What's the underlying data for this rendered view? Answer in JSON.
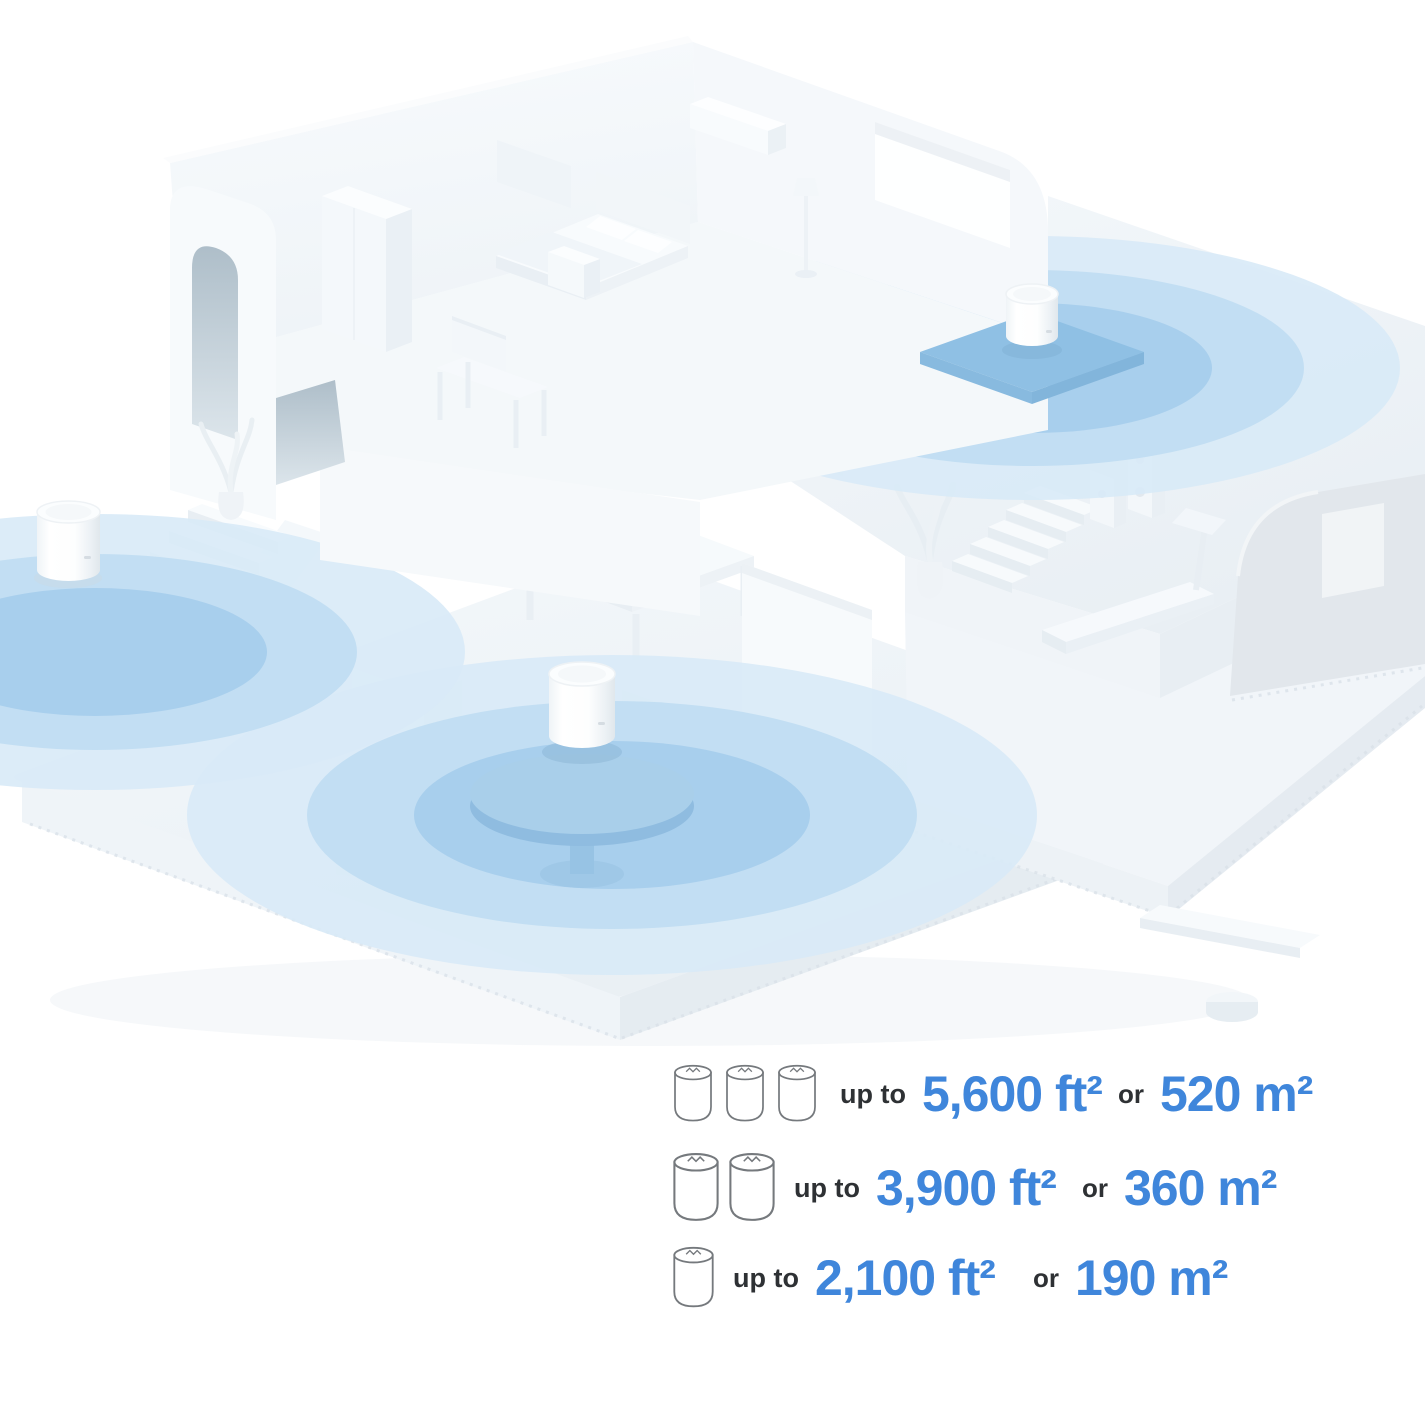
{
  "colors": {
    "accent_blue": "#3F86DB",
    "text_dark": "#2E3134",
    "icon_stroke": "#75797D",
    "coverage_outer": "#D8EAF7",
    "coverage_mid": "#BFDDF2",
    "coverage_inner": "#A6CDEC"
  },
  "scene": {
    "units": [
      {
        "name": "mesh-unit-upper-floor"
      },
      {
        "name": "mesh-unit-left"
      },
      {
        "name": "mesh-unit-living-room"
      }
    ]
  },
  "legend": {
    "rows": [
      {
        "pack": 3,
        "prefix": "up to",
        "imperial": "5,600 ft²",
        "conjunction": "or",
        "metric": "520 m²"
      },
      {
        "pack": 2,
        "prefix": "up to",
        "imperial": "3,900 ft²",
        "conjunction": "or",
        "metric": "360 m²"
      },
      {
        "pack": 1,
        "prefix": "up to",
        "imperial": "2,100 ft²",
        "conjunction": "or",
        "metric": "190 m²"
      }
    ]
  }
}
